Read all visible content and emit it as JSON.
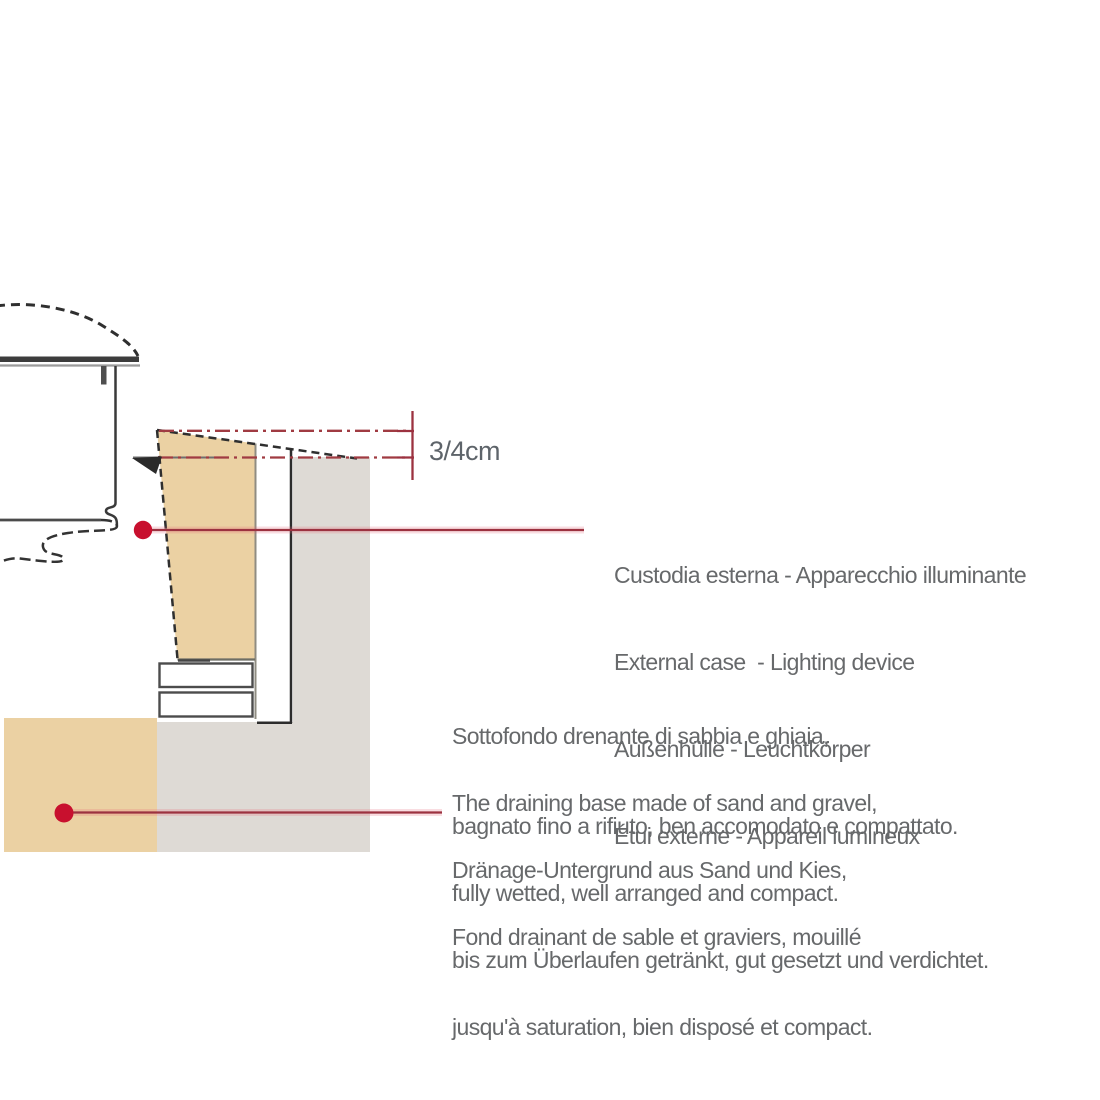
{
  "dimension": {
    "label": "3/4cm"
  },
  "labels": {
    "case": {
      "lines": [
        "Custodia esterna - Apparecchio illuminante",
        "External case  - Lighting device",
        "Außenhülle - Leuchtkörper",
        "Étui externe - Appareil lumineux"
      ]
    },
    "base": {
      "it": [
        "Sottofondo drenante di sabbia e ghiaia,",
        "bagnato fino a rifiuto, ben accomodato e compattato."
      ],
      "en": [
        "The draining base made of sand and gravel,",
        "fully wetted, well arranged and compact."
      ],
      "de": [
        "Dränage-Untergrund aus Sand und Kies,",
        "bis zum Überlaufen getränkt, gut gesetzt und verdichtet."
      ],
      "fr": [
        "Fond drainant de sable et graviers, mouillé",
        "jusqu'à saturation, bien disposé et compact."
      ]
    }
  },
  "colors": {
    "tan": "#ebd1a3",
    "gray": "#dedad5",
    "red_dot": "#c8102e",
    "leader": "#9c3240",
    "dashdot": "#a03b42",
    "ink": "#333333",
    "text": "#67696b"
  }
}
